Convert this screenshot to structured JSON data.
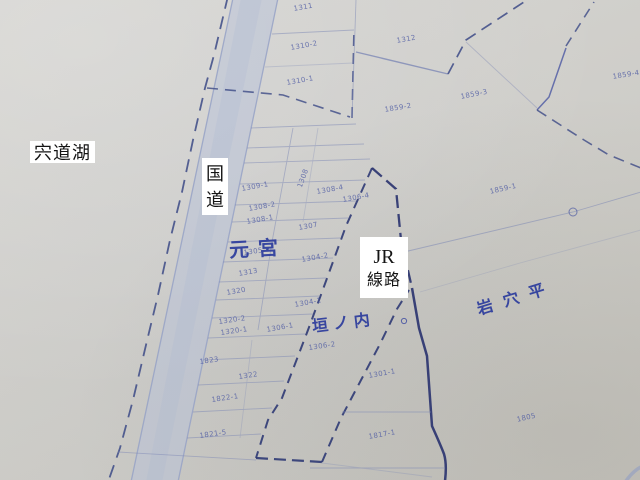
{
  "map": {
    "kind": "cadastral-map-photo",
    "overlays": {
      "lake": {
        "text": "宍道湖"
      },
      "road": {
        "chars": [
          "国",
          "道"
        ]
      },
      "railway": {
        "line1": "JR",
        "line2": "線路"
      }
    },
    "area_labels": {
      "motomiya": {
        "text": "元宮"
      },
      "kakinouchi": {
        "text": "垣ノ内"
      },
      "iwanahira": {
        "text": "岩穴平"
      }
    },
    "parcels": [
      {
        "n": "1311",
        "x": 293,
        "y": 5,
        "r": -10
      },
      {
        "n": "1310-2",
        "x": 290,
        "y": 44,
        "r": -10
      },
      {
        "n": "1310-1",
        "x": 286,
        "y": 79,
        "r": -10
      },
      {
        "n": "1312",
        "x": 396,
        "y": 37,
        "r": -10
      },
      {
        "n": "1859-2",
        "x": 384,
        "y": 106,
        "r": -9
      },
      {
        "n": "1859-3",
        "x": 460,
        "y": 93,
        "r": -11
      },
      {
        "n": "1859-4",
        "x": 612,
        "y": 73,
        "r": -9
      },
      {
        "n": "1859-1",
        "x": 489,
        "y": 188,
        "r": -13
      },
      {
        "n": "1309-1",
        "x": 241,
        "y": 185,
        "r": -10
      },
      {
        "n": "1308",
        "x": 296,
        "y": 186,
        "r": -70
      },
      {
        "n": "1308-4",
        "x": 316,
        "y": 188,
        "r": -10
      },
      {
        "n": "1308-2",
        "x": 248,
        "y": 205,
        "r": -10
      },
      {
        "n": "1308-1",
        "x": 246,
        "y": 218,
        "r": -10
      },
      {
        "n": "1306-4",
        "x": 342,
        "y": 196,
        "r": -10
      },
      {
        "n": "1307",
        "x": 298,
        "y": 224,
        "r": -10
      },
      {
        "n": "1305",
        "x": 243,
        "y": 249,
        "r": -8
      },
      {
        "n": "1304-2",
        "x": 301,
        "y": 256,
        "r": -10
      },
      {
        "n": "1313",
        "x": 238,
        "y": 270,
        "r": -10
      },
      {
        "n": "1320",
        "x": 226,
        "y": 289,
        "r": -10
      },
      {
        "n": "1304-1",
        "x": 294,
        "y": 301,
        "r": -10
      },
      {
        "n": "1320-2",
        "x": 218,
        "y": 318,
        "r": -8
      },
      {
        "n": "1320-1",
        "x": 220,
        "y": 329,
        "r": -8
      },
      {
        "n": "1306-1",
        "x": 266,
        "y": 326,
        "r": -10
      },
      {
        "n": "1306-2",
        "x": 308,
        "y": 344,
        "r": -8
      },
      {
        "n": "1301-1",
        "x": 368,
        "y": 372,
        "r": -10
      },
      {
        "n": "1823",
        "x": 199,
        "y": 358,
        "r": -8
      },
      {
        "n": "1322",
        "x": 238,
        "y": 373,
        "r": -8
      },
      {
        "n": "1822-1",
        "x": 211,
        "y": 396,
        "r": -8
      },
      {
        "n": "1821-5",
        "x": 199,
        "y": 432,
        "r": -8
      },
      {
        "n": "1817-1",
        "x": 368,
        "y": 433,
        "r": -10
      },
      {
        "n": "1805",
        "x": 516,
        "y": 416,
        "r": -13
      }
    ],
    "colors": {
      "paper": "#cfcec9",
      "thin_line_blue": "#7d88b5",
      "dashed_blue": "#3c4a86",
      "heavy_blue": "#2c3570",
      "road_fill": "#b8c2d9",
      "road_edge": "#96a2c6",
      "parcel_number_blue": "#4b58a3",
      "area_label_blue": "#2c3c9d",
      "overlay_bg": "#ffffff",
      "overlay_text": "#141414"
    }
  }
}
